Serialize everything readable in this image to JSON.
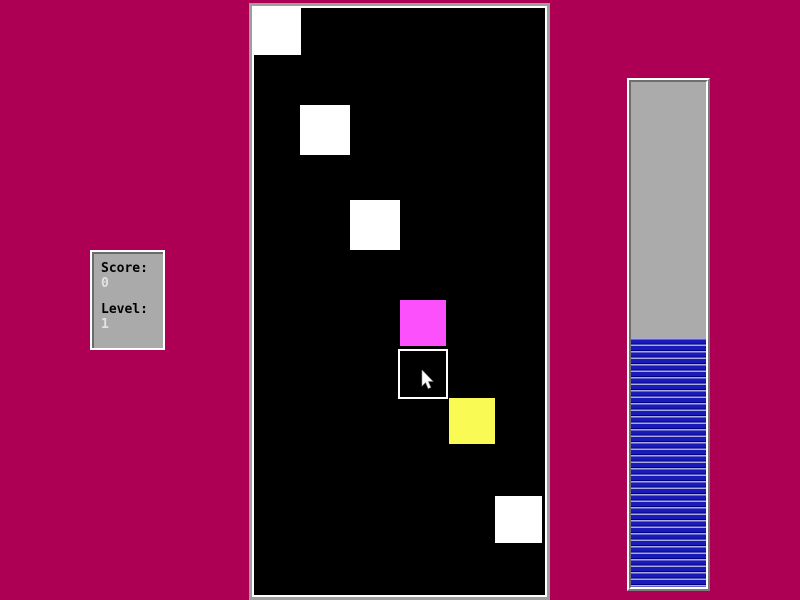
{
  "app": {
    "name": "block-catch-game",
    "background_color": "#ad0055"
  },
  "score_panel": {
    "score_label": "Score:",
    "score_value": "0",
    "level_label": "Level:",
    "level_value": "1",
    "panel_color": "#aaaaaa",
    "label_color": "#000000",
    "value_color": "#e2e2e2"
  },
  "playfield": {
    "background_color": "#000000",
    "frame_outer_color": "#9e9e9e",
    "frame_inner_color": "#ffffff",
    "squares": [
      {
        "type": "falling-block",
        "color": "#ffffff",
        "x": 0,
        "y": 0,
        "size": 47
      },
      {
        "type": "falling-block",
        "color": "#ffffff",
        "x": 46,
        "y": 97,
        "size": 50
      },
      {
        "type": "falling-block",
        "color": "#ffffff",
        "x": 96,
        "y": 192,
        "size": 50
      },
      {
        "type": "falling-block",
        "color": "#fc50fc",
        "x": 146,
        "y": 292,
        "size": 46
      },
      {
        "type": "catcher",
        "color": "#000000",
        "border": "#ffffff",
        "x": 144,
        "y": 341,
        "size": 50
      },
      {
        "type": "falling-block",
        "color": "#fafa55",
        "x": 195,
        "y": 390,
        "size": 46
      },
      {
        "type": "falling-block",
        "color": "#ffffff",
        "x": 241,
        "y": 488,
        "size": 47
      }
    ],
    "cursor": {
      "x": 167,
      "y": 362
    }
  },
  "progress_bar": {
    "fill_percent": 49.3,
    "empty_color": "#ababab",
    "fill_color": "#1a1ab8",
    "stripe_dark": "#000085",
    "stripe_light": "#a9a9dd"
  }
}
